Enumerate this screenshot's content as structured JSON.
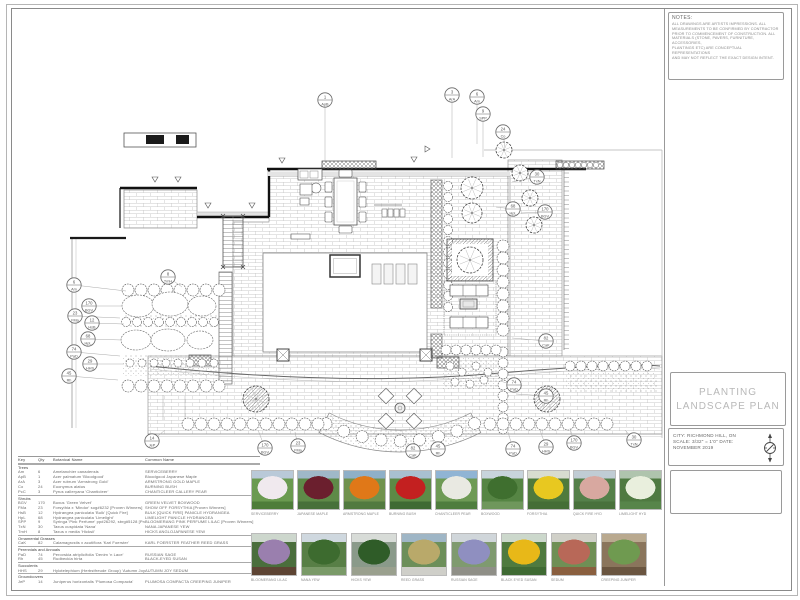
{
  "sheet": {
    "notes": {
      "title": "NOTES:",
      "body": "ALL DRAWINGS ARE ARTISTS IMPRESSIONS. ALL\nMEASUREMENTS TO BE CONFIRMED BY CONTRACTOR\nPRIOR TO COMMENCEMENT OF CONSTRUCTION. ALL\nMATERIALS (STONE, PAVERS, FURNITURE, ACCESSORIES,\nPLANTINGS ETC) ARE CONCEPTUAL REPRESENTATIONS\nAND MAY NOT REFLECT THE EXACT DESIGN INTENT."
    },
    "title_block": {
      "title_line1": "PLANTING",
      "title_line2": "LANDSCAPE PLAN",
      "city": "CITY: RICHMOND HILL, ON",
      "scale": "SCALE: 3/32\" = 1'0\" DATE:",
      "date": "NOVEMBER 2019"
    }
  },
  "legend": {
    "headers": {
      "key": "Key",
      "qty": "Qty",
      "botanical": "Botanical Name",
      "common": "Common Name"
    },
    "sections": [
      {
        "name": "Trees",
        "rows": [
          [
            "Am",
            "6",
            "Amelanchier canadensis",
            "SERVICEBERRY"
          ],
          [
            "ApB",
            "1",
            "Acer palmatum 'Bloodgood'",
            "Bloodgood Japanese Maple"
          ],
          [
            "ArA",
            "3",
            "Acer rubrum 'Armstrong Gold'",
            "ARMSTRONG GOLD MAPLE"
          ],
          [
            "Co",
            "24",
            "Euonymus alatus",
            "BURNING BUSH"
          ],
          [
            "PcC",
            "3",
            "Pyrus calleryana 'Chanticleer'",
            "CHANTICLEER CALLERY PEAR"
          ]
        ]
      },
      {
        "name": "Shrubs",
        "rows": [
          [
            "BGV",
            "170",
            "Buxus 'Green Velvet'",
            "GREEN VELVET BOXWOOD"
          ],
          [
            "FMa",
            "23",
            "Forsythia x 'Mindor' sog#6232 [Proven Winners]",
            "SHOW OFF FORSYTHIA [Proven Winners]"
          ],
          [
            "HsB",
            "12",
            "Hydrangea paniculata 'Bulk' [Quick Fire]",
            "BULK [QUICK FIRE] PANICLE HYDRANGEA"
          ],
          [
            "HpL",
            "68",
            "Hydrangea paniculata 'Limelight'",
            "LIMELIGHT PANICLE HYDRANGEA"
          ],
          [
            "SPP",
            "9",
            "Syringa 'Pink Perfume' pp#26292, sbrg#5128 [Proven Winners]",
            "BLOOMERANG PINK PERFUME LILAC [Proven Winners]"
          ],
          [
            "TxN",
            "30",
            "Taxus cuspidata 'Nana'",
            "NANA JAPANESE YEW"
          ],
          [
            "TmH",
            "8",
            "Taxus x media 'Hicksii'",
            "HICKS ANGLOJAPANESE YEW"
          ]
        ]
      },
      {
        "name": "Ornamental Grasses",
        "rows": [
          [
            "CaK",
            "82",
            "Calamagrostis x acutiflora 'Karl Foerster'",
            "KARL FOERSTER FEATHER REED GRASS"
          ]
        ]
      },
      {
        "name": "Perennials and Annuals",
        "rows": [
          [
            "PaD",
            "74",
            "Perovskia atriplicifolia 'Denim 'n Lace'",
            "RUSSIAN SAGE"
          ],
          [
            "Rh",
            "45",
            "Rudbeckia hirta",
            "BLACK-EYED SUSAN"
          ]
        ]
      },
      {
        "name": "Succulents",
        "rows": [
          [
            "HHS",
            "29",
            "Hylotelephium (Herbstfreude Group) 'Autumn Joy'",
            "AUTUMN JOY SEDUM"
          ]
        ]
      },
      {
        "name": "Groundcovers",
        "rows": [
          [
            "JeP",
            "14",
            "Juniperus horizontalis 'Plumosa Compacta'",
            "PLUMOSA COMPACTA CREEPING JUNIPER"
          ]
        ]
      }
    ]
  },
  "photos": {
    "top": [
      {
        "label": "SERVICEBERRY",
        "sky": "#b9c9d8",
        "blob": "#f0e9ee",
        "mid": "#6a9a50",
        "ground": "#4e7d3a"
      },
      {
        "label": "JAPANESE MAPLE",
        "sky": "#9fb8c8",
        "blob": "#6b1f2e",
        "mid": "#5e8a48",
        "ground": "#47703a"
      },
      {
        "label": "ARMSTRONG MAPLE",
        "sky": "#8fb0c8",
        "blob": "#e07818",
        "mid": "#70924e",
        "ground": "#527a40"
      },
      {
        "label": "BURNING BUSH",
        "sky": "#a8c0d0",
        "blob": "#c32020",
        "mid": "#5d8a46",
        "ground": "#3f6a33"
      },
      {
        "label": "CHANTICLEER PEAR",
        "sky": "#90b4d4",
        "blob": "#e9e9e2",
        "mid": "#6e9a55",
        "ground": "#4f7d3e"
      },
      {
        "label": "BOXWOOD",
        "sky": "#c8d4dc",
        "blob": "#3f6f2f",
        "mid": "#568544",
        "ground": "#6f975c"
      },
      {
        "label": "FORSYTHIA",
        "sky": "#d8dcd0",
        "blob": "#e8c820",
        "mid": "#4f7a3c",
        "ground": "#456e36"
      },
      {
        "label": "QUICK FIRE HYD",
        "sky": "#c0ccd4",
        "blob": "#d8a8a0",
        "mid": "#55804a",
        "ground": "#49713c"
      },
      {
        "label": "LIMELIGHT HYD",
        "sky": "#afc4ad",
        "blob": "#e9efdd",
        "mid": "#4f7a41",
        "ground": "#57854a"
      }
    ],
    "bottom": [
      {
        "label": "BLOOMERANG LILAC",
        "sky": "#cdd7cd",
        "blob": "#9a7fae",
        "mid": "#4a6e3c",
        "ground": "#5d4433"
      },
      {
        "label": "NANA YEW",
        "sky": "#cfd8df",
        "blob": "#3d6b2f",
        "mid": "#587f46",
        "ground": "#7a9a68"
      },
      {
        "label": "HICKS YEW",
        "sky": "#d8dcd8",
        "blob": "#2f5c28",
        "mid": "#8a9a8a",
        "ground": "#9aa08e"
      },
      {
        "label": "REED GRASS",
        "sky": "#9fb6c6",
        "blob": "#b9a96a",
        "mid": "#6d8f5a",
        "ground": "#cfcfc9"
      },
      {
        "label": "RUSSIAN SAGE",
        "sky": "#d0d6da",
        "blob": "#8f8fc0",
        "mid": "#7f9a6f",
        "ground": "#8f8f87"
      },
      {
        "label": "BLACK EYED SUSAN",
        "sky": "#ccd8cc",
        "blob": "#e8b818",
        "mid": "#4f7a3f",
        "ground": "#3f6a33"
      },
      {
        "label": "SEDUM",
        "sky": "#d0d0c8",
        "blob": "#b86858",
        "mid": "#6f8f55",
        "ground": "#8a5f3f"
      },
      {
        "label": "CREEPING JUNIPER",
        "sky": "#b9a98f",
        "blob": "#6f9a50",
        "mid": "#8a755c",
        "ground": "#6a5540"
      }
    ]
  },
  "plan": {
    "callouts": [
      {
        "x": 325,
        "y": 100,
        "qty": "1",
        "code": "ApB",
        "tx": 325,
        "ty": 162
      },
      {
        "x": 452,
        "y": 95,
        "qty": "3",
        "code": "ArA",
        "tx": 452,
        "ty": 158
      },
      {
        "x": 477,
        "y": 97,
        "qty": "6",
        "code": "Am",
        "tx": 477,
        "ty": 144
      },
      {
        "x": 483,
        "y": 114,
        "qty": "9",
        "code": "SPP",
        "tx": 483,
        "ty": 157
      },
      {
        "x": 503,
        "y": 132,
        "qty": "24",
        "code": "Co",
        "tx": 505,
        "ty": 148
      },
      {
        "x": 537,
        "y": 177,
        "qty": "30",
        "code": "TxN",
        "tx": 512,
        "ty": 182
      },
      {
        "x": 513,
        "y": 209,
        "qty": "68",
        "code": "HpL",
        "tx": 496,
        "ty": 207
      },
      {
        "x": 545,
        "y": 212,
        "qty": "170",
        "code": "BGV",
        "tx": 521,
        "ty": 213
      },
      {
        "x": 546,
        "y": 341,
        "qty": "82",
        "code": "CaK",
        "tx": 512,
        "ty": 338
      },
      {
        "x": 514,
        "y": 385,
        "qty": "74",
        "code": "PaD",
        "tx": 500,
        "ty": 381
      },
      {
        "x": 546,
        "y": 396,
        "qty": "45",
        "code": "Rh",
        "tx": 516,
        "ty": 394
      },
      {
        "x": 74,
        "y": 285,
        "qty": "6",
        "code": "Am",
        "tx": 126,
        "ty": 291
      },
      {
        "x": 89,
        "y": 306,
        "qty": "170",
        "code": "BGV",
        "tx": 122,
        "ty": 306
      },
      {
        "x": 75,
        "y": 316,
        "qty": "23",
        "code": "FMa",
        "tx": 120,
        "ty": 318
      },
      {
        "x": 92,
        "y": 323,
        "qty": "12",
        "code": "HsB",
        "tx": 124,
        "ty": 324
      },
      {
        "x": 88,
        "y": 339,
        "qty": "68",
        "code": "HpL",
        "tx": 122,
        "ty": 340
      },
      {
        "x": 74,
        "y": 352,
        "qty": "74",
        "code": "PaD",
        "tx": 120,
        "ty": 356
      },
      {
        "x": 90,
        "y": 364,
        "qty": "29",
        "code": "HHS",
        "tx": 124,
        "ty": 364
      },
      {
        "x": 69,
        "y": 376,
        "qty": "45",
        "code": "Rh",
        "tx": 118,
        "ty": 380
      },
      {
        "x": 168,
        "y": 277,
        "qty": "8",
        "code": "TmH",
        "tx": 182,
        "ty": 287
      },
      {
        "x": 152,
        "y": 441,
        "qty": "14",
        "code": "JeP",
        "tx": 165,
        "ty": 430
      },
      {
        "x": 265,
        "y": 448,
        "qty": "170",
        "code": "BGV",
        "tx": 258,
        "ty": 430
      },
      {
        "x": 298,
        "y": 446,
        "qty": "23",
        "code": "FMa",
        "tx": 295,
        "ty": 432
      },
      {
        "x": 413,
        "y": 451,
        "qty": "82",
        "code": "CaK",
        "tx": 405,
        "ty": 441
      },
      {
        "x": 438,
        "y": 449,
        "qty": "45",
        "code": "Rh",
        "tx": 432,
        "ty": 440
      },
      {
        "x": 513,
        "y": 449,
        "qty": "74",
        "code": "PaD",
        "tx": 508,
        "ty": 432
      },
      {
        "x": 546,
        "y": 447,
        "qty": "29",
        "code": "HHS",
        "tx": 540,
        "ty": 430
      },
      {
        "x": 574,
        "y": 443,
        "qty": "170",
        "code": "BGV",
        "tx": 570,
        "ty": 428
      },
      {
        "x": 634,
        "y": 440,
        "qty": "30",
        "code": "TxN",
        "tx": 625,
        "ty": 430
      }
    ]
  }
}
